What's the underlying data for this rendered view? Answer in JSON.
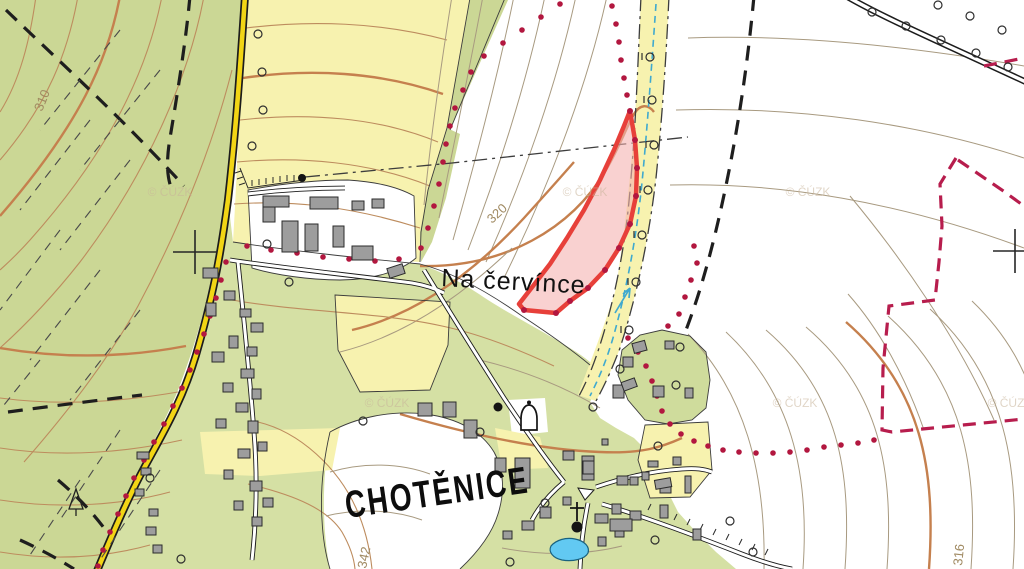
{
  "labels": {
    "village_name": "CHOTĚNICE",
    "locality_name": "Na červínce",
    "watermark": "© ČÚZK"
  },
  "contour_labels": {
    "c310": "310",
    "c320": "320",
    "c342": "342",
    "c316": "316"
  },
  "icons": {
    "chapel": "bell-outline",
    "wayside-cross": "cross-with-dot",
    "grid-cross": "+",
    "tree": "open-circle",
    "conifer": "triangle-with-trunk",
    "flow-arrow": "arrow-ne"
  },
  "colors": {
    "forest": "#cbd795",
    "field-yellow": "#f7f2af",
    "village-green": "#d5e0a4",
    "garden-green": "#cfdc9c",
    "contour-thin": "#a89a80",
    "contour-index": "#c5804e",
    "contour-forest": "#bd8c5e",
    "contour-label": "#a08a62",
    "road-yellow": "#f2d515",
    "road-casing": "#1c1c1c",
    "building-fill": "#9d9d9d",
    "building-stroke": "#2b2b2b",
    "parcel-stroke": "#e7403a",
    "parcel-fill": "#f5b2b0",
    "boundary-dot": "#b2173f",
    "cadastre-magenta": "#b71d4d",
    "water-fill": "#62c9f2",
    "water-stroke": "#19627f",
    "stream-blue": "#3fa9cf",
    "path-black": "#1e1e1e",
    "dashdot-gray": "#3d3d3d",
    "watermark": "#c8b49a",
    "text-black": "#111111"
  }
}
